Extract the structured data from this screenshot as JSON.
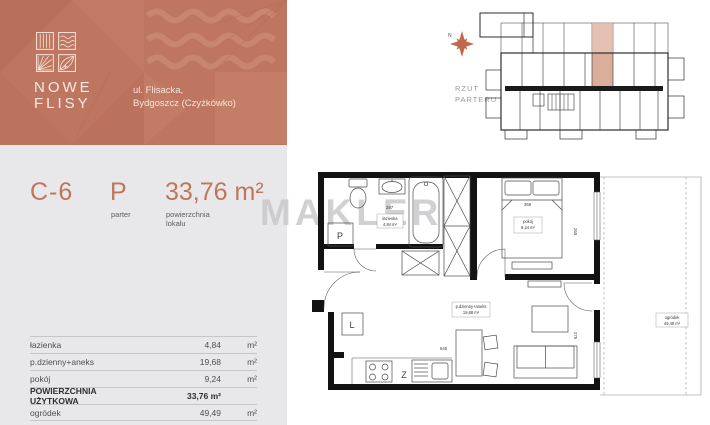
{
  "header": {
    "logo_line1": "NOWE",
    "logo_line2": "FLISY",
    "address_line1": "ul. Flisacka,",
    "address_line2": "Bydgoszcz (Czyżkówko)"
  },
  "unit": {
    "code": "C-6",
    "floor": "P",
    "floor_caption": "parter",
    "area": "33,76 m²",
    "area_caption_line1": "powierzchnia",
    "area_caption_line2": "lokalu"
  },
  "areas_table": {
    "rows": [
      {
        "label": "łazienka",
        "value": "4,84",
        "unit": "m²"
      },
      {
        "label": "p.dzienny+aneks",
        "value": "19,68",
        "unit": "m²"
      },
      {
        "label": "pokój",
        "value": "9,24",
        "unit": "m²"
      }
    ],
    "total_label": "POWIERZCHNIA UŻYTKOWA",
    "total_value": "33,76 m²",
    "garden_label": "ogródek",
    "garden_value": "49,49",
    "garden_unit": "m²"
  },
  "site_plan": {
    "compass": "N",
    "caption_line1": "RZUT",
    "caption_line2": "PARTERU"
  },
  "plan": {
    "bathroom_name": "łazienka",
    "bathroom_area": "4,84 m²",
    "bedroom_name": "pokój",
    "bedroom_area": "9,24 m²",
    "living_name": "p.dzienny+aneks",
    "living_area": "19,68 m²",
    "garden_name": "ogródek",
    "garden_area": "49,49 m²",
    "washer_marker": "P",
    "fridge_marker": "L",
    "sink_marker": "Z",
    "dim_bathroom": "297",
    "dim_bedroom": "369",
    "dim_living": "645",
    "dim_right_top": "269",
    "dim_right_bottom": "275"
  },
  "watermark": "MAKLER",
  "colors": {
    "accent": "#c0765a",
    "header_bg": "#bf7660",
    "panel_bg": "#e8e8ea",
    "highlight": "#d5a08a"
  }
}
